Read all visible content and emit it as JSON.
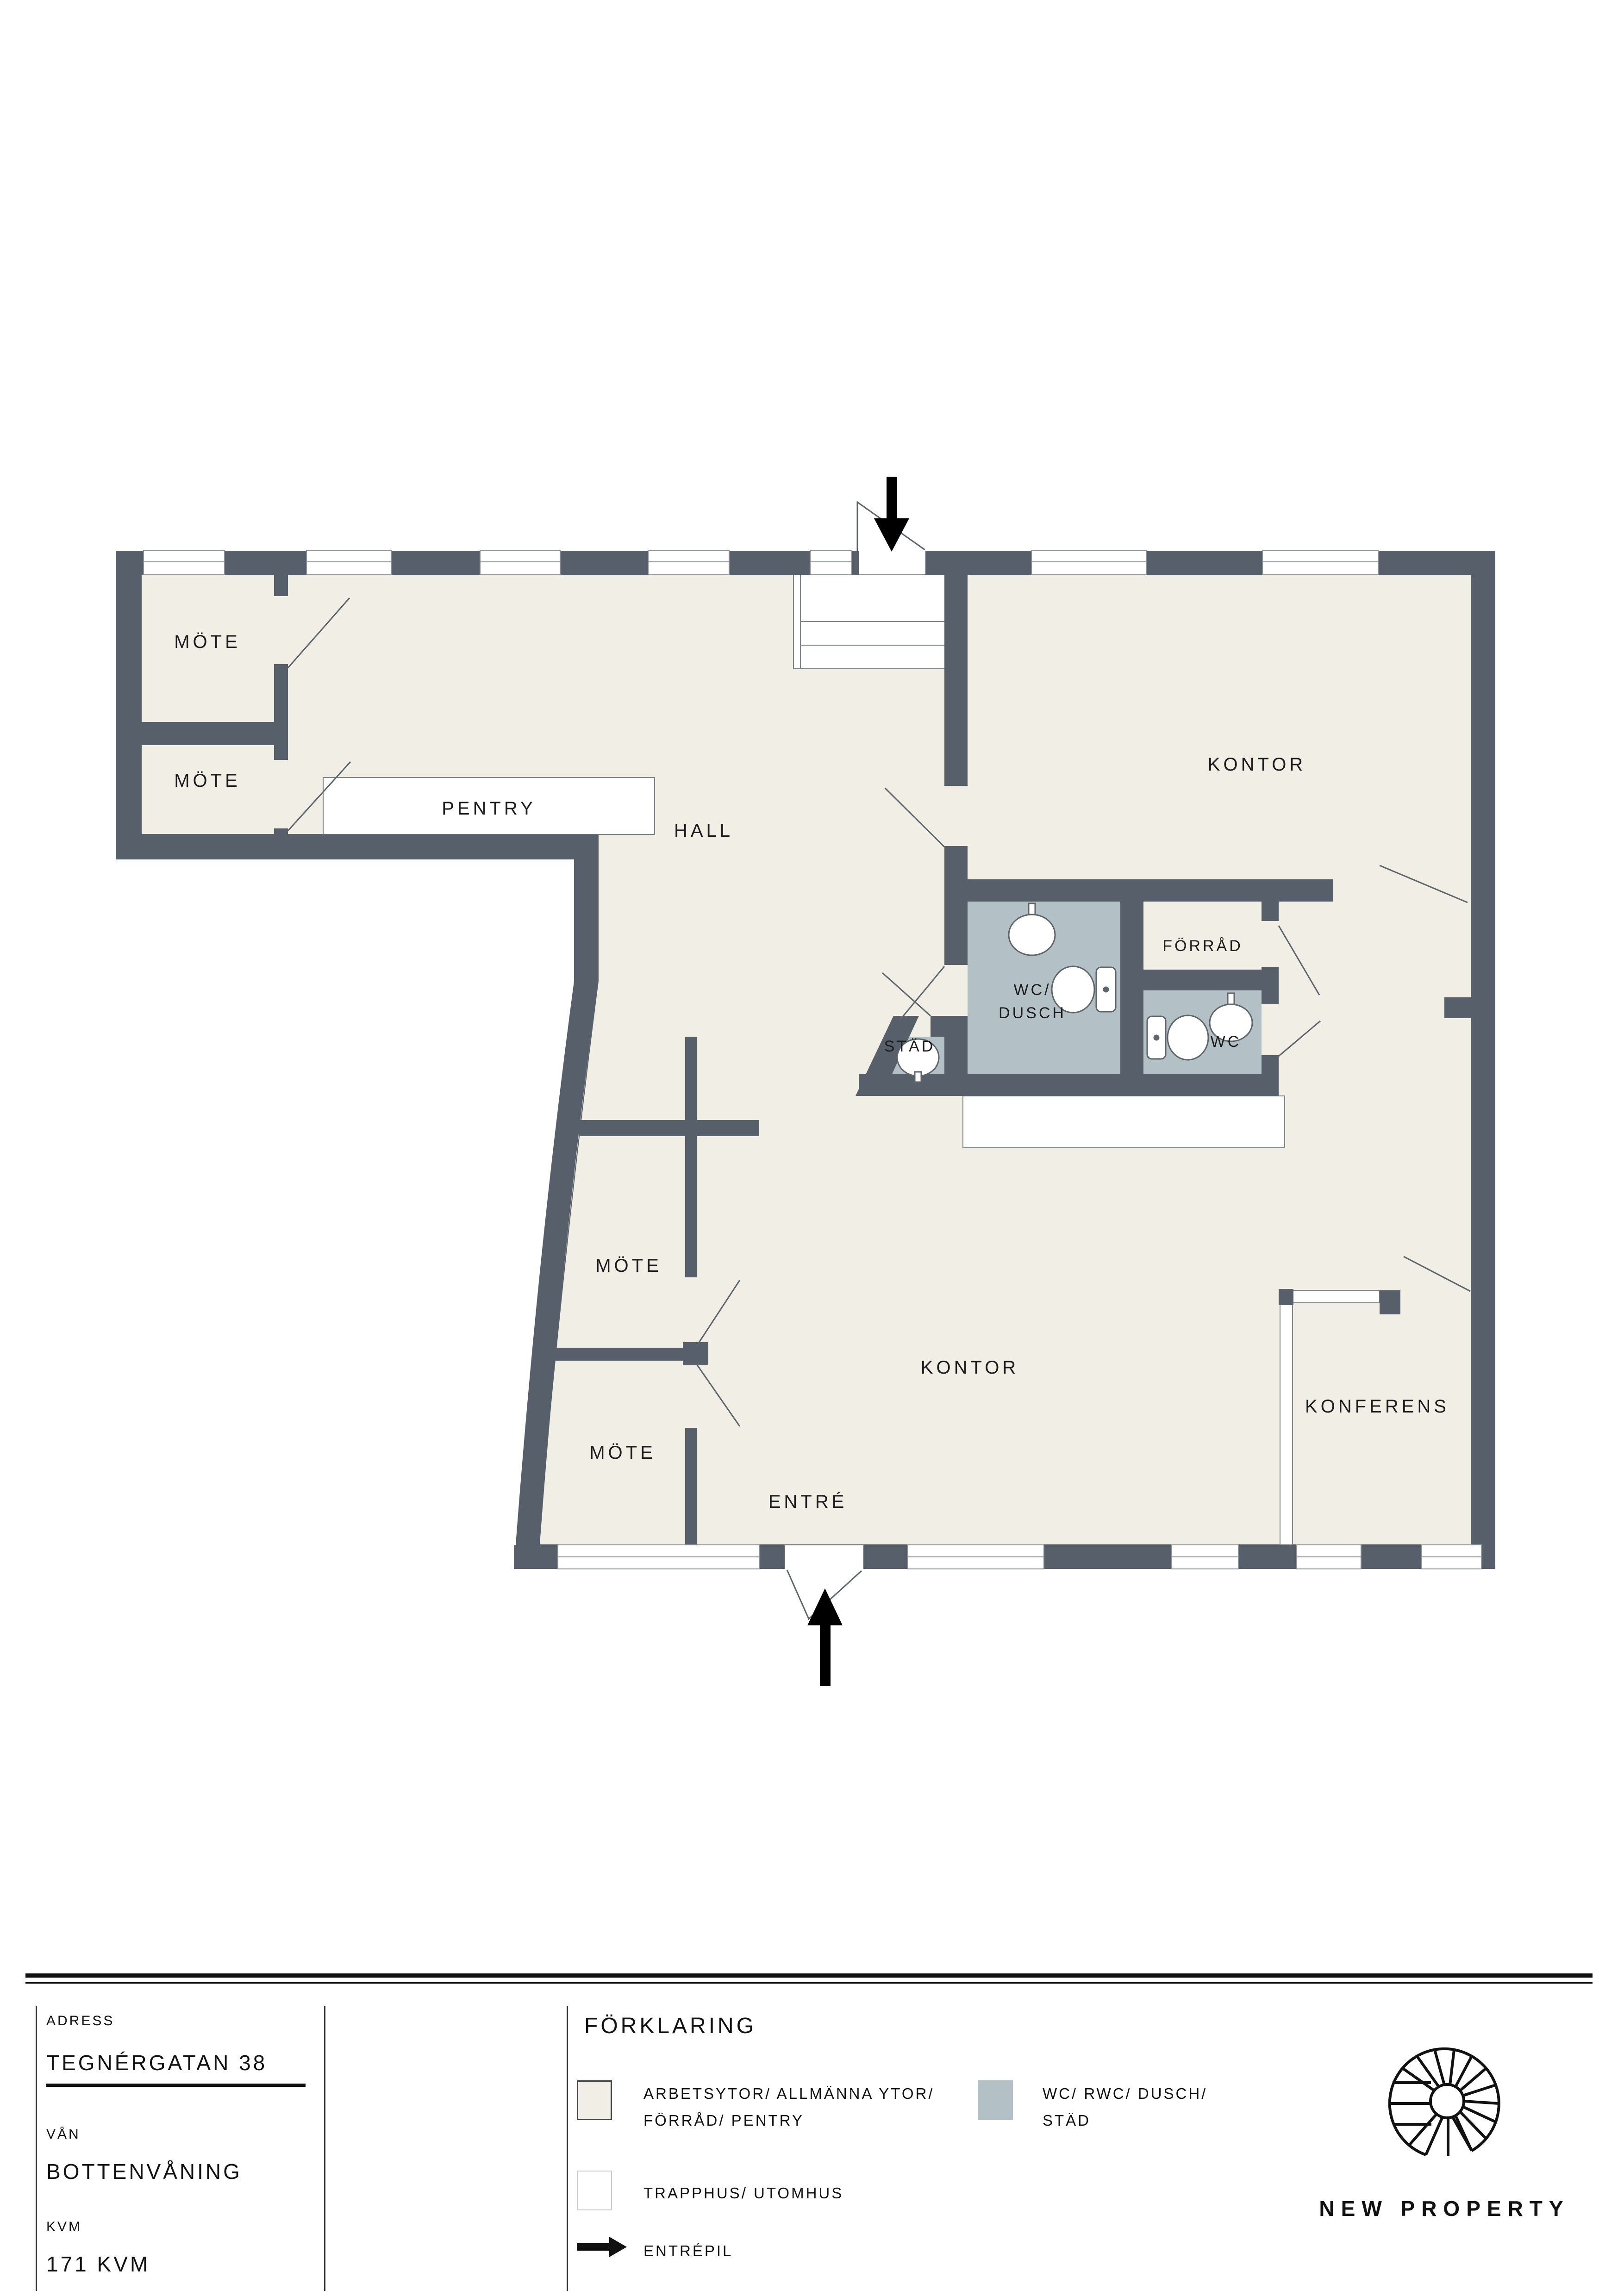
{
  "floorplan": {
    "labels": {
      "mote_top_1": "MÖTE",
      "mote_top_2": "MÖTE",
      "pentry": "PENTRY",
      "hall": "HALL",
      "kontor_upper": "KONTOR",
      "forrad": "FÖRRÅD",
      "wc_dusch_line1": "WC/",
      "wc_dusch_line2": "DUSCH",
      "stad": "STÄD",
      "wc": "WC",
      "mote_lower_1": "MÖTE",
      "mote_lower_2": "MÖTE",
      "kontor_lower": "KONTOR",
      "konferens": "KONFERENS",
      "entre": "ENTRÉ"
    },
    "colors": {
      "wall": "#57606A",
      "work_area": "#F1EEE5",
      "wet_area": "#B3C0C6",
      "outdoor": "#FFFFFF"
    }
  },
  "footer": {
    "address_label": "ADRESS",
    "address_value": "TEGNÉRGATAN 38",
    "floor_label": "VÅN",
    "floor_value": "BOTTENVÅNING",
    "area_label": "KVM",
    "area_value": "171 KVM",
    "legend": {
      "title": "FÖRKLARING",
      "item1_line1": "ARBETSYTOR/ ALLMÄNNA YTOR/",
      "item1_line2": "FÖRRÅD/ PENTRY",
      "item2_line1": "WC/ RWC/ DUSCH/",
      "item2_line2": "STÄD",
      "item3_line1": "TRAPPHUS/ UTOMHUS",
      "arrow_label": "ENTRÉPIL"
    },
    "brand": "NEW PROPERTY"
  }
}
